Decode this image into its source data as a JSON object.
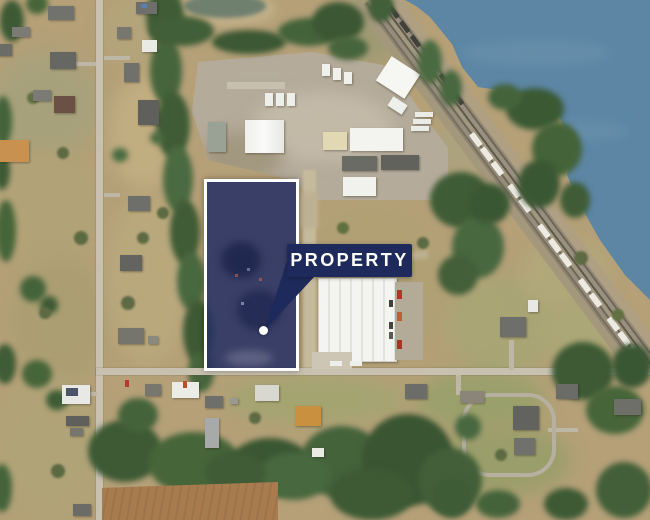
{
  "map": {
    "annotation": {
      "label": "PROPERTY"
    }
  },
  "colors": {
    "accent_navy": "#1E2A5B",
    "property_fill": "rgba(35,46,99,0.85)",
    "property_border": "#FFFFFF",
    "water_blue": "#5C86A4",
    "marker_dot": "#FFFFFF"
  }
}
